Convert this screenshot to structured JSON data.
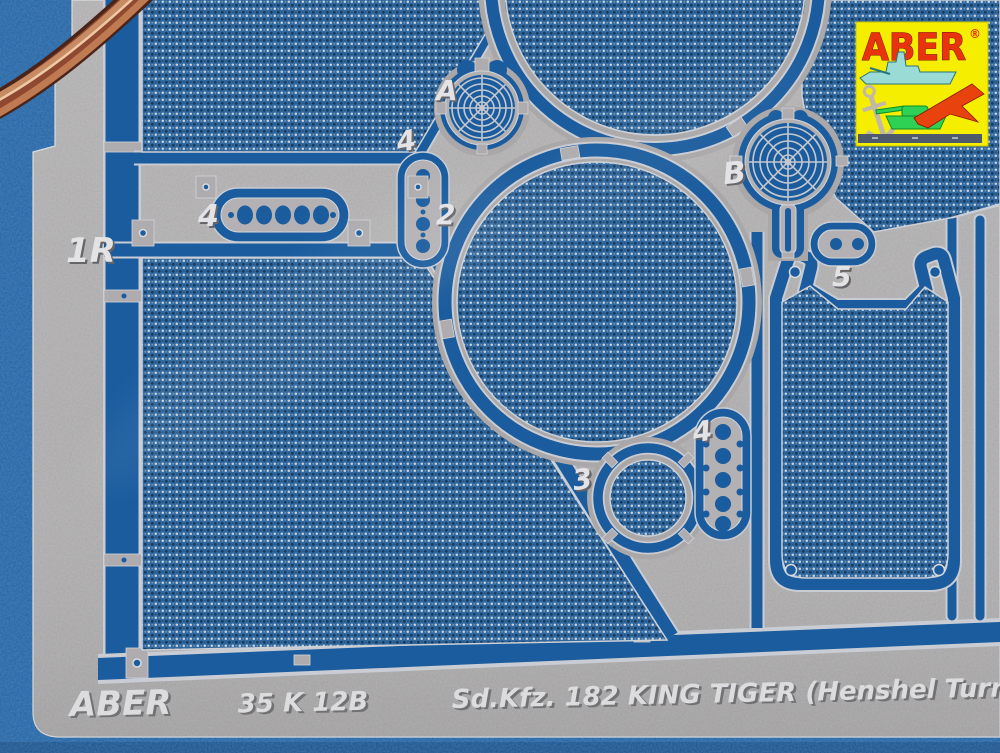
{
  "scene": {
    "type": "photograph",
    "subject": "Photo-etched metal detail fret with mesh grilles on a blue background, copper wire at top-left corner",
    "background_color": "#1f63a6",
    "metal_color": "#a9a7a8",
    "mesh_color": "#30689f",
    "channel_color": "#1a5c9e",
    "wire_color": "#8e4930"
  },
  "logo": {
    "brand": "ABER",
    "registered_mark": "®",
    "colors": {
      "background": "#f5ee00",
      "text": "#e8330c",
      "ship": "#9adbd6",
      "tank": "#2ed153",
      "jet": "#e8430e",
      "anchor": "#c2b8a8",
      "bar": "#4e5a6c"
    }
  },
  "part_labels": {
    "frame_1r": "1R",
    "bracket_4": "4",
    "strip_4": "4",
    "strip_2": "2",
    "grille_a": "A",
    "grille_b": "B",
    "disc_3": "3",
    "ladder_4": "4",
    "panel_5": "5"
  },
  "footer": {
    "brand": "ABER",
    "product_code": "35 K 12B",
    "title": "Sd.Kfz. 182 KING TIGER (Henshel Turr"
  }
}
